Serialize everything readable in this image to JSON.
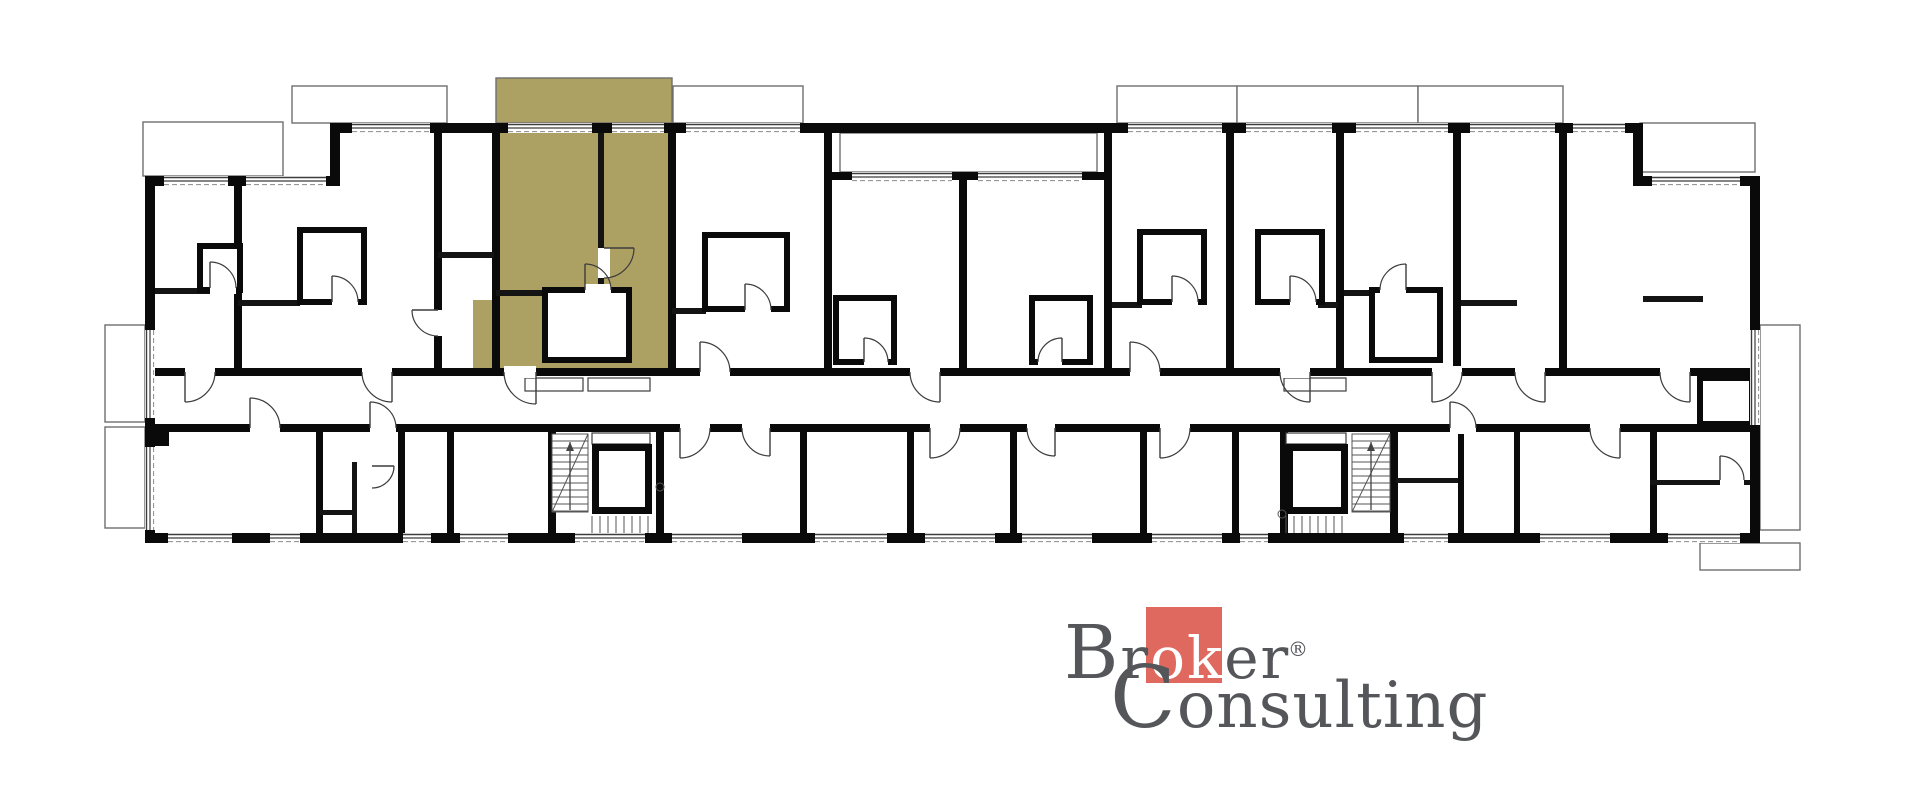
{
  "logo": {
    "cap1": "B",
    "r1": "r",
    "mid": "ok",
    "post": "er",
    "cap2": "C",
    "rest2": "onsulting",
    "reg": "®",
    "text_color": "#55565a",
    "square_color": "#e0695f",
    "mid_color": "#ffffff"
  },
  "plan": {
    "background": "#ffffff",
    "wall_color": "#0a0a0a",
    "partition_color": "#141414",
    "line_color": "#3c3c3c",
    "balcony_line_color": "#6e6e6e",
    "highlight_color": "#ada063",
    "walls": [
      [
        145,
        176,
        195,
        10
      ],
      [
        330,
        123,
        10,
        63
      ],
      [
        330,
        123,
        1313,
        10
      ],
      [
        1633,
        123,
        10,
        63
      ],
      [
        1633,
        176,
        127,
        10
      ],
      [
        145,
        176,
        10,
        367
      ],
      [
        1750,
        176,
        10,
        367
      ],
      [
        145,
        533,
        1615,
        10
      ],
      [
        155,
        368,
        1595,
        8
      ],
      [
        155,
        424,
        1595,
        8
      ],
      [
        234,
        186,
        8,
        182
      ],
      [
        434,
        133,
        8,
        235
      ],
      [
        492,
        133,
        8,
        235
      ],
      [
        668,
        133,
        8,
        235
      ],
      [
        824,
        133,
        8,
        235
      ],
      [
        959,
        180,
        8,
        188
      ],
      [
        1104,
        133,
        8,
        235
      ],
      [
        1226,
        133,
        8,
        235
      ],
      [
        1336,
        133,
        8,
        235
      ],
      [
        1453,
        133,
        8,
        235
      ],
      [
        1559,
        133,
        8,
        235
      ],
      [
        832,
        172,
        272,
        8
      ],
      [
        316,
        432,
        7,
        101
      ],
      [
        398,
        432,
        7,
        101
      ],
      [
        447,
        432,
        7,
        101
      ],
      [
        548,
        428,
        8,
        105
      ],
      [
        656,
        428,
        8,
        105
      ],
      [
        800,
        432,
        7,
        101
      ],
      [
        907,
        432,
        7,
        101
      ],
      [
        1010,
        432,
        7,
        101
      ],
      [
        1140,
        432,
        7,
        101
      ],
      [
        1232,
        432,
        7,
        101
      ],
      [
        1280,
        428,
        8,
        105
      ],
      [
        1390,
        428,
        8,
        105
      ],
      [
        1458,
        432,
        6,
        101
      ],
      [
        1514,
        432,
        6,
        101
      ],
      [
        1650,
        432,
        7,
        101
      ],
      [
        155,
        432,
        14,
        14
      ]
    ],
    "partitions": [
      [
        155,
        288,
        80,
        6
      ],
      [
        238,
        300,
        62,
        6
      ],
      [
        438,
        252,
        56,
        6
      ],
      [
        598,
        133,
        6,
        159
      ],
      [
        496,
        290,
        50,
        6
      ],
      [
        672,
        308,
        34,
        6
      ],
      [
        1112,
        302,
        30,
        6
      ],
      [
        1318,
        302,
        20,
        6
      ],
      [
        1344,
        290,
        30,
        6
      ],
      [
        1461,
        300,
        56,
        6
      ],
      [
        1643,
        296,
        60,
        6
      ],
      [
        352,
        462,
        5,
        71
      ],
      [
        320,
        510,
        37,
        5
      ],
      [
        1396,
        478,
        62,
        5
      ],
      [
        1650,
        480,
        100,
        5
      ]
    ],
    "boxes": [
      [
        200,
        246,
        40,
        44
      ],
      [
        300,
        230,
        64,
        72
      ],
      [
        545,
        290,
        84,
        70
      ],
      [
        705,
        235,
        82,
        74
      ],
      [
        836,
        298,
        58,
        64
      ],
      [
        1032,
        298,
        58,
        64
      ],
      [
        1140,
        232,
        64,
        70
      ],
      [
        1258,
        232,
        64,
        70
      ],
      [
        1372,
        290,
        68,
        70
      ],
      [
        1700,
        378,
        52,
        46
      ]
    ],
    "highlight_shapes": [
      [
        496,
        78,
        176,
        45
      ],
      [
        496,
        123,
        176,
        245
      ],
      [
        473,
        300,
        23,
        68
      ]
    ],
    "balconies": [
      [
        292,
        86,
        155,
        37
      ],
      [
        673,
        86,
        130,
        37
      ],
      [
        1117,
        86,
        120,
        37
      ],
      [
        1237,
        86,
        181,
        37
      ],
      [
        1418,
        86,
        145,
        37
      ],
      [
        143,
        122,
        140,
        54
      ],
      [
        1640,
        123,
        115,
        49
      ],
      [
        105,
        325,
        40,
        97
      ],
      [
        105,
        427,
        40,
        101
      ],
      [
        1760,
        325,
        40,
        205
      ],
      [
        1700,
        543,
        100,
        27
      ],
      [
        840,
        133,
        257,
        39
      ]
    ],
    "vents": [
      [
        525,
        378,
        58,
        13
      ],
      [
        588,
        378,
        62,
        13
      ],
      [
        1284,
        378,
        62,
        13
      ],
      [
        592,
        433,
        58,
        11
      ],
      [
        1286,
        433,
        60,
        11
      ]
    ],
    "windows_h": [
      [
        352,
        123,
        78
      ],
      [
        508,
        123,
        84
      ],
      [
        612,
        123,
        52
      ],
      [
        686,
        123,
        114
      ],
      [
        1128,
        123,
        94
      ],
      [
        1246,
        123,
        86
      ],
      [
        1356,
        123,
        92
      ],
      [
        1470,
        123,
        85
      ],
      [
        1573,
        123,
        52
      ],
      [
        852,
        172,
        100
      ],
      [
        978,
        172,
        104
      ],
      [
        164,
        176,
        64
      ],
      [
        246,
        176,
        80
      ],
      [
        1652,
        176,
        88
      ],
      [
        168,
        533,
        64
      ],
      [
        270,
        533,
        30
      ],
      [
        403,
        533,
        28
      ],
      [
        460,
        533,
        48
      ],
      [
        575,
        533,
        70
      ],
      [
        672,
        533,
        70
      ],
      [
        815,
        533,
        72
      ],
      [
        925,
        533,
        70
      ],
      [
        1022,
        533,
        70
      ],
      [
        1152,
        533,
        70
      ],
      [
        1240,
        533,
        28
      ],
      [
        1404,
        533,
        44
      ],
      [
        1540,
        533,
        70
      ],
      [
        1668,
        533,
        72
      ]
    ],
    "windows_v": [
      [
        145,
        330,
        88
      ],
      [
        145,
        447,
        83
      ],
      [
        1750,
        330,
        95
      ]
    ],
    "doors": [
      [
        185,
        372,
        30,
        "dr"
      ],
      [
        392,
        372,
        30,
        "dl"
      ],
      [
        536,
        372,
        32,
        "dl"
      ],
      [
        700,
        372,
        30,
        "ur"
      ],
      [
        940,
        372,
        30,
        "dl"
      ],
      [
        1130,
        372,
        30,
        "ur"
      ],
      [
        1310,
        372,
        30,
        "dl"
      ],
      [
        1432,
        372,
        30,
        "dr"
      ],
      [
        1545,
        372,
        30,
        "dl"
      ],
      [
        1690,
        372,
        30,
        "dl"
      ],
      [
        250,
        428,
        30,
        "ur"
      ],
      [
        370,
        428,
        26,
        "ur"
      ],
      [
        680,
        428,
        30,
        "dr"
      ],
      [
        770,
        428,
        28,
        "dl"
      ],
      [
        930,
        428,
        30,
        "dr"
      ],
      [
        1055,
        428,
        28,
        "dl"
      ],
      [
        1160,
        428,
        30,
        "dr"
      ],
      [
        1450,
        428,
        26,
        "ur"
      ],
      [
        1620,
        428,
        30,
        "dl"
      ],
      [
        604,
        248,
        30,
        "rd"
      ],
      [
        585,
        290,
        26,
        "ur"
      ],
      [
        332,
        302,
        26,
        "ur"
      ],
      [
        745,
        310,
        26,
        "ur"
      ],
      [
        864,
        362,
        24,
        "ur"
      ],
      [
        1062,
        362,
        24,
        "ul"
      ],
      [
        1172,
        302,
        26,
        "ur"
      ],
      [
        1290,
        302,
        26,
        "ur"
      ],
      [
        1406,
        290,
        26,
        "ul"
      ],
      [
        210,
        288,
        26,
        "ur"
      ],
      [
        438,
        310,
        26,
        "ld"
      ],
      [
        372,
        466,
        22,
        "rd"
      ],
      [
        1720,
        480,
        24,
        "ur"
      ]
    ],
    "stairs": [
      {
        "flight": [
          552,
          434,
          36,
          78
        ],
        "diag": [
          552,
          512,
          588,
          434
        ],
        "arrow": [
          570,
          510,
          570,
          442
        ],
        "elevator": [
          592,
          444,
          60,
          70
        ],
        "hatch": [
          592,
          516,
          60,
          17
        ],
        "circle": [
          660,
          487,
          4
        ]
      },
      {
        "flight": [
          1352,
          434,
          38,
          78
        ],
        "diag": [
          1352,
          512,
          1390,
          434
        ],
        "arrow": [
          1371,
          510,
          1371,
          442
        ],
        "elevator": [
          1286,
          444,
          62,
          70
        ],
        "hatch": [
          1286,
          516,
          62,
          17
        ],
        "circle": [
          1282,
          514,
          4
        ]
      }
    ]
  }
}
